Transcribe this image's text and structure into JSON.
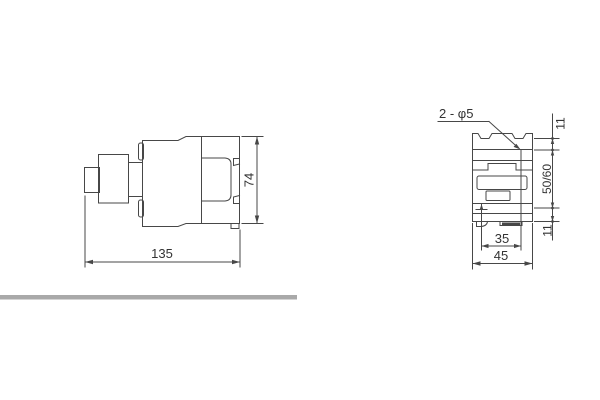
{
  "drawing": {
    "side_view": {
      "width_mm": "135",
      "height_mm": "74"
    },
    "front_view": {
      "hole_callout": "2 - φ5",
      "top_hole_offset_mm": "11",
      "vertical_hole_pitch_mm": "50/60",
      "bottom_hole_offset_mm": "11",
      "horizontal_hole_pitch_mm": "35",
      "width_mm": "45"
    }
  },
  "colors": {
    "line": "#474747",
    "text": "#333333",
    "divider_bar": "#a9a9a9",
    "background": "#ffffff"
  }
}
